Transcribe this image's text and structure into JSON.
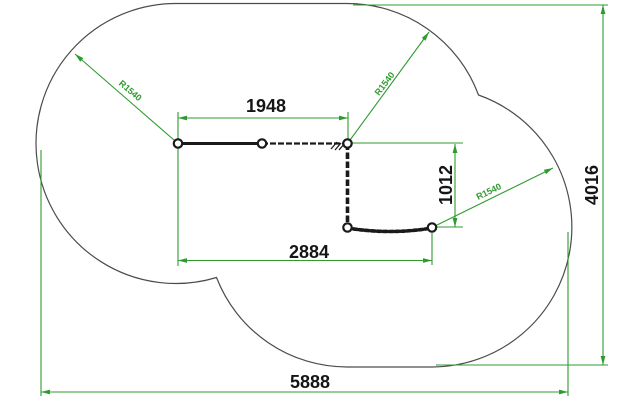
{
  "drawing": {
    "labels": {
      "width_top": "1948",
      "width_mid": "2884",
      "width_total": "5888",
      "height_inner": "1012",
      "height_total": "4016",
      "radius_1": "R1540",
      "radius_2": "R1540",
      "radius_3": "R1540"
    },
    "colors": {
      "dimension_green": "#2f9b2f",
      "outline_gray": "#4c4c4c",
      "structure_black": "#1a1a1a",
      "background": "#ffffff"
    }
  }
}
